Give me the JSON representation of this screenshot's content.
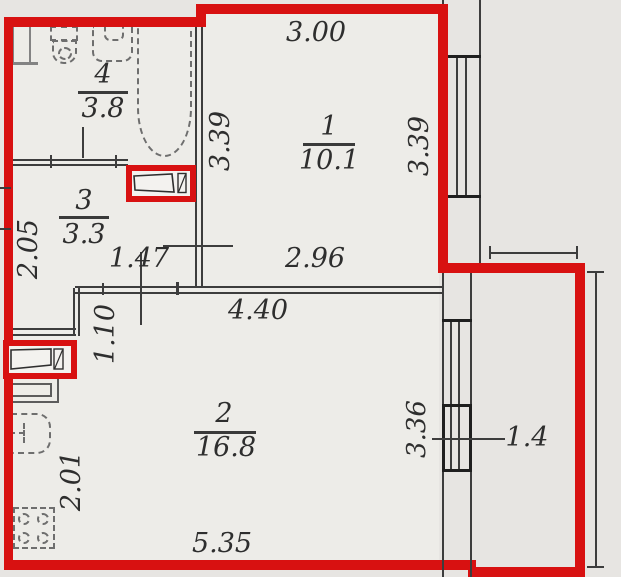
{
  "title": "apartment-floor-plan",
  "colors": {
    "wall_red": "#d81111",
    "line": "#3d3d3d",
    "background": "#e7e5e2",
    "floor": "#edece8"
  },
  "rooms": {
    "r1": {
      "number": "1",
      "area": "10.1"
    },
    "r2": {
      "number": "2",
      "area": "16.8"
    },
    "r3": {
      "number": "3",
      "area": "3.3"
    },
    "r4": {
      "number": "4",
      "area": "3.8"
    }
  },
  "dims": {
    "top_width": "3.00",
    "r1_left_height": "3.39",
    "r1_right_height": "3.39",
    "r1_bottom_width": "2.96",
    "hall_width": "1.47",
    "r2_top_width": "4.40",
    "r2_bottom_width": "5.35",
    "entry_width": "1.10",
    "left_upper_height": "2.05",
    "left_lower_height": "2.01",
    "balcony_window_height": "3.36",
    "balcony_area": "1.4"
  }
}
